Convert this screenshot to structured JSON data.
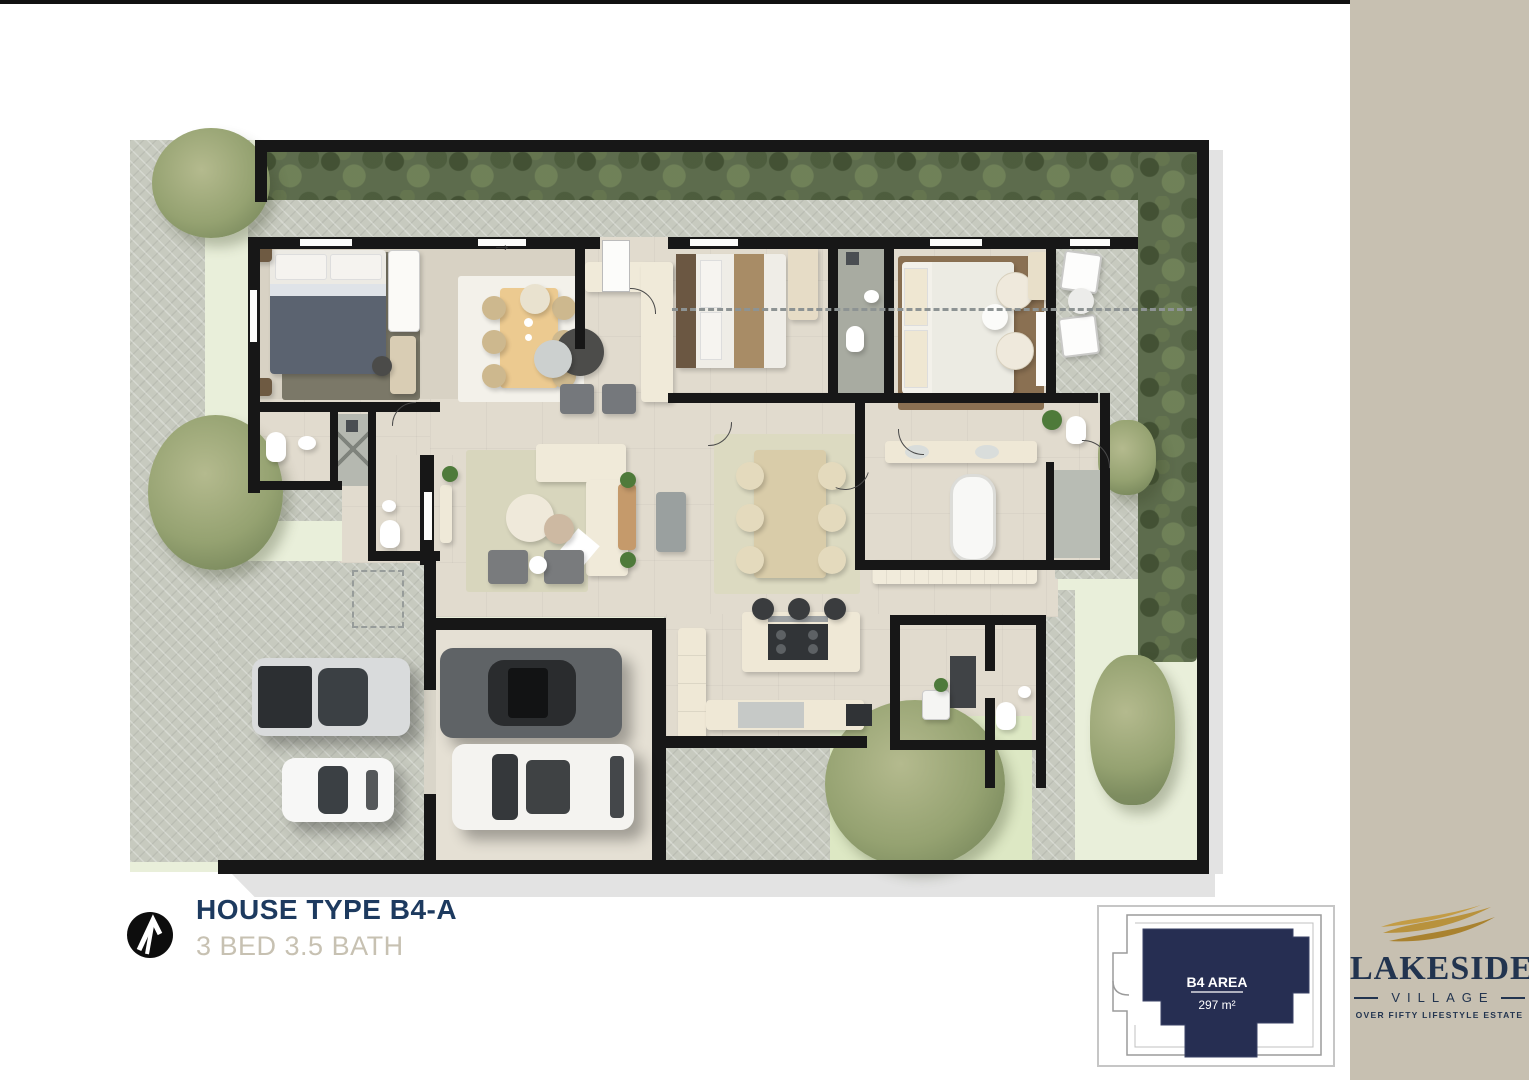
{
  "title_block": {
    "title": "HOUSE TYPE B4-A",
    "subtitle": "3 BED 3.5 BATH"
  },
  "plan": {
    "entrance_arrow": "→"
  },
  "inset": {
    "area_label": "B4 AREA",
    "area_value": "297 m²"
  },
  "brand": {
    "name": "LAKESIDE",
    "word": "VILLAGE",
    "tagline": "OVER FIFTY LIFESTYLE ESTATE"
  },
  "colors": {
    "title_navy": "#1d3a5f",
    "subtitle_gray": "#c7c1b2",
    "sidebar_beige": "#c7c0b1",
    "logo_navy": "#22344f",
    "logo_gold": "#b8923d",
    "inset_navy": "#262e52"
  }
}
